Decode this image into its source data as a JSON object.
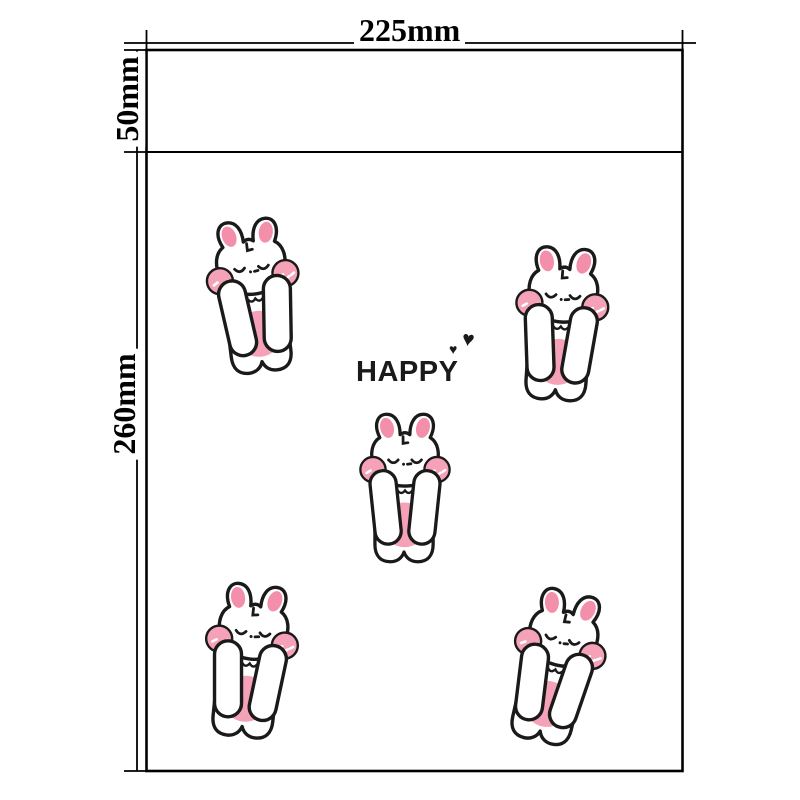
{
  "diagram": {
    "type": "packaging-bag-dimension-drawing",
    "labels": {
      "width": "225mm",
      "flap_height": "50mm",
      "body_height": "260mm"
    },
    "print": {
      "text": "HAPPY",
      "heart_small": "♥",
      "heart_large": "♥",
      "bunny_count": 5
    },
    "colors": {
      "background": "#ffffff",
      "dimension_lines": "#000000",
      "print_text": "#1a1a1a",
      "bunny_outline": "#1a1a1a",
      "bunny_pink": "#f5a2b8",
      "bunny_inner_ear": "#f48fab"
    },
    "bunnies": [
      {
        "x": 255,
        "y": 296,
        "rotation": -7,
        "scale": 1
      },
      {
        "x": 561,
        "y": 324,
        "rotation": 4,
        "scale": 1
      },
      {
        "x": 405,
        "y": 488,
        "rotation": 0,
        "scale": 0.97
      },
      {
        "x": 250,
        "y": 661,
        "rotation": 6,
        "scale": 1
      },
      {
        "x": 556,
        "y": 667,
        "rotation": 13,
        "scale": 1
      }
    ]
  }
}
